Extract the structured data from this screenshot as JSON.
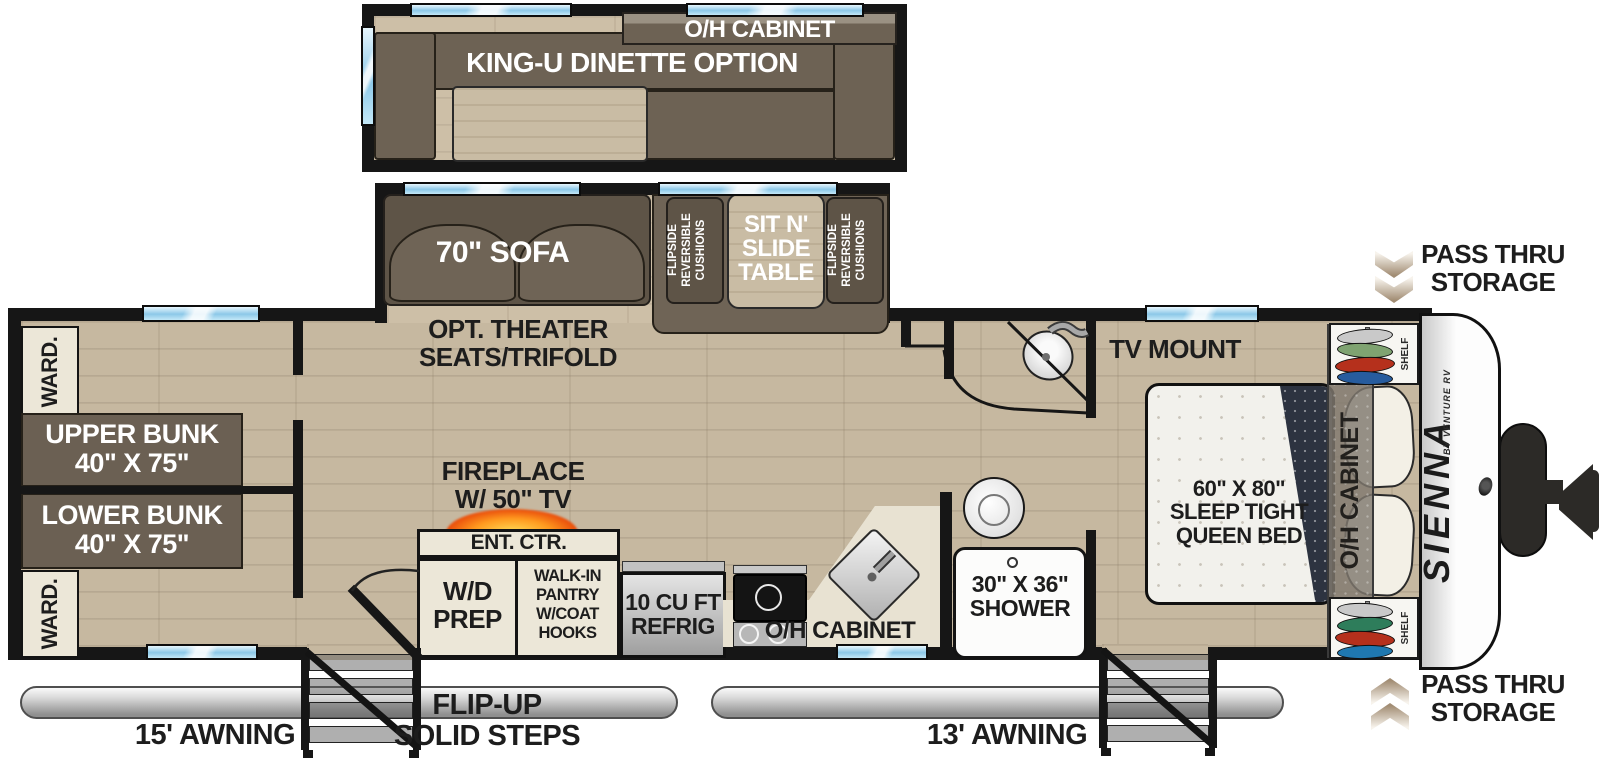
{
  "colors": {
    "wall": "#161616",
    "floor_wood": "#c6b8a0",
    "window_blue": "#8cc8e8",
    "sofa_brown": "#6f6456",
    "cabinet_cream": "#ece7d8",
    "flame_orange": "#ff8a1e",
    "bed_white": "#f2f1ec",
    "comforter_navy": "#2d3340",
    "awning_gray": "#bfbfbf",
    "kayak_silver": "#c9c9c9",
    "kayak_green": "#7fa371",
    "kayak_red": "#b5301c",
    "kayak_blue": "#275c9e"
  },
  "slide_dinette": {
    "cabinet_label": "O/H CABINET",
    "option_label": "KING-U DINETTE OPTION"
  },
  "slide_sofa": {
    "sofa_label": "70\" SOFA",
    "cushion_left_label": "FLIPSIDE\nREVERSIBLE\nCUSHIONS",
    "table_label": "SIT N'\nSLIDE\nTABLE",
    "cushion_right_label": "FLIPSIDE\nREVERSIBLE\nCUSHIONS"
  },
  "bunk_room": {
    "wardrobe_top": "WARD.",
    "upper_bunk": "UPPER BUNK\n40\" X 75\"",
    "lower_bunk": "LOWER BUNK\n40\" X 75\"",
    "wardrobe_bottom": "WARD."
  },
  "living": {
    "theater_label": "OPT. THEATER\nSEATS/TRIFOLD",
    "fireplace_label": "FIREPLACE\nW/ 50\" TV",
    "ent_ctr_label": "ENT. CTR.",
    "wd_prep_label": "W/D\nPREP",
    "pantry_label": "WALK-IN\nPANTRY\nW/COAT\nHOOKS"
  },
  "kitchen": {
    "refrig_label": "10 CU FT\nREFRIG",
    "cabinet_label": "O/H CABINET"
  },
  "bath": {
    "shower_label": "30\" X 36\"\nSHOWER"
  },
  "bedroom": {
    "tv_label": "TV MOUNT",
    "bed_label": "60\" X 80\"\nSLEEP TIGHT\nQUEEN BED",
    "cabinet_label": "O/H CABINET",
    "shelf_top_label": "SHELF",
    "shelf_bottom_label": "SHELF"
  },
  "exterior": {
    "brand": "SIENNA",
    "brand_sub": "BY VENTURE RV",
    "pass_thru_top": "PASS THRU\nSTORAGE",
    "pass_thru_bottom": "PASS THRU\nSTORAGE",
    "awning_left": "15' AWNING",
    "awning_right": "13' AWNING",
    "steps_label": "FLIP-UP\nSOLID STEPS"
  }
}
